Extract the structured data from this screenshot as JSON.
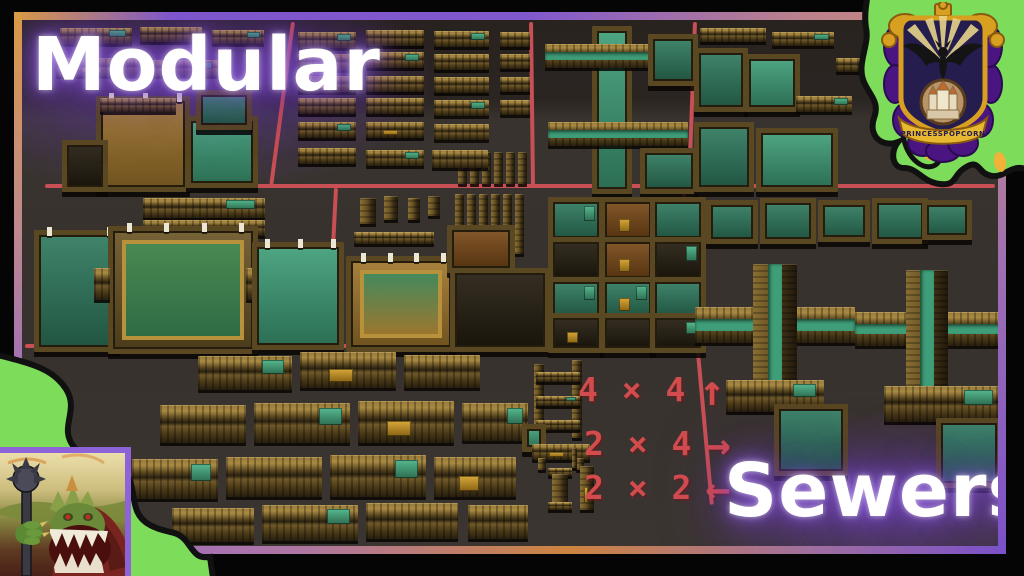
{
  "titles": {
    "left": "Modular",
    "right": "Sewers"
  },
  "legend": {
    "rows": [
      {
        "size": "4 × 4",
        "arrow": "↑"
      },
      {
        "size": "2 × 4",
        "arrow": "→"
      },
      {
        "size": "2 × 2",
        "arrow": "←"
      }
    ]
  },
  "crest": {
    "banner_text": "PRINCESSPOPCORN"
  },
  "colors": {
    "grid_red": "#c84f55",
    "pixel_text_red": "#d24c4e",
    "slime_green": "#7ddc5a",
    "slime_spot_yellow": "#f0b238",
    "glow_purple": "#8050d8",
    "border_orange": "#d99a45",
    "border_purple": "#7e55cc",
    "module_brown": "#8a6f33",
    "water_teal": "#3f9e78"
  },
  "icons": {
    "crest": "heraldic-crest-icon",
    "slime_top_right": "slime-blob-icon",
    "slime_bottom_left": "slime-blob-icon",
    "monster": "monster-artwork"
  }
}
